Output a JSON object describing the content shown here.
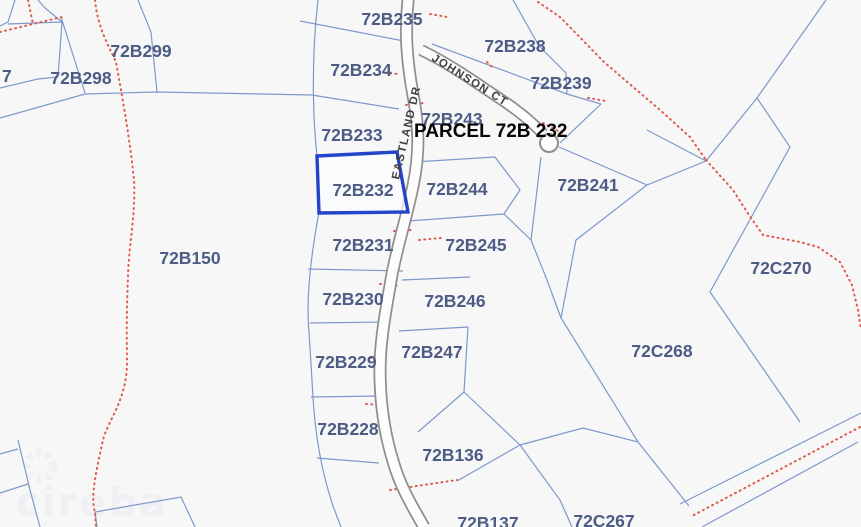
{
  "map": {
    "annotation": "PARCEL 72B 232",
    "selected_parcel": "72B232",
    "watermark": "cireba",
    "edge_label": "7",
    "roads": [
      {
        "name": "EASTLAND DR"
      },
      {
        "name": "JOHNSON CT"
      }
    ],
    "parcels": [
      {
        "id": "72B299"
      },
      {
        "id": "72B298"
      },
      {
        "id": "72B235"
      },
      {
        "id": "72B234"
      },
      {
        "id": "72B233"
      },
      {
        "id": "72B232"
      },
      {
        "id": "72B231"
      },
      {
        "id": "72B230"
      },
      {
        "id": "72B229"
      },
      {
        "id": "72B228"
      },
      {
        "id": "72B243"
      },
      {
        "id": "72B244"
      },
      {
        "id": "72B245"
      },
      {
        "id": "72B246"
      },
      {
        "id": "72B247"
      },
      {
        "id": "72B238"
      },
      {
        "id": "72B239"
      },
      {
        "id": "72B241"
      },
      {
        "id": "72B150"
      },
      {
        "id": "72C270"
      },
      {
        "id": "72C268"
      },
      {
        "id": "72C267"
      },
      {
        "id": "72B136"
      },
      {
        "id": "72B137"
      }
    ],
    "colors": {
      "background": "#f7f7f8",
      "parcel_line": "#7d98cb",
      "red_boundary": "#df594d",
      "highlight_border": "#2344cb",
      "parcel_label": "#4d5c85",
      "annotation_text": "#050505",
      "road_fill": "#fdfdfd",
      "road_casing": "#8f8f8f",
      "road_label": "#3f3f3f",
      "watermark": "#eef0f4"
    }
  }
}
